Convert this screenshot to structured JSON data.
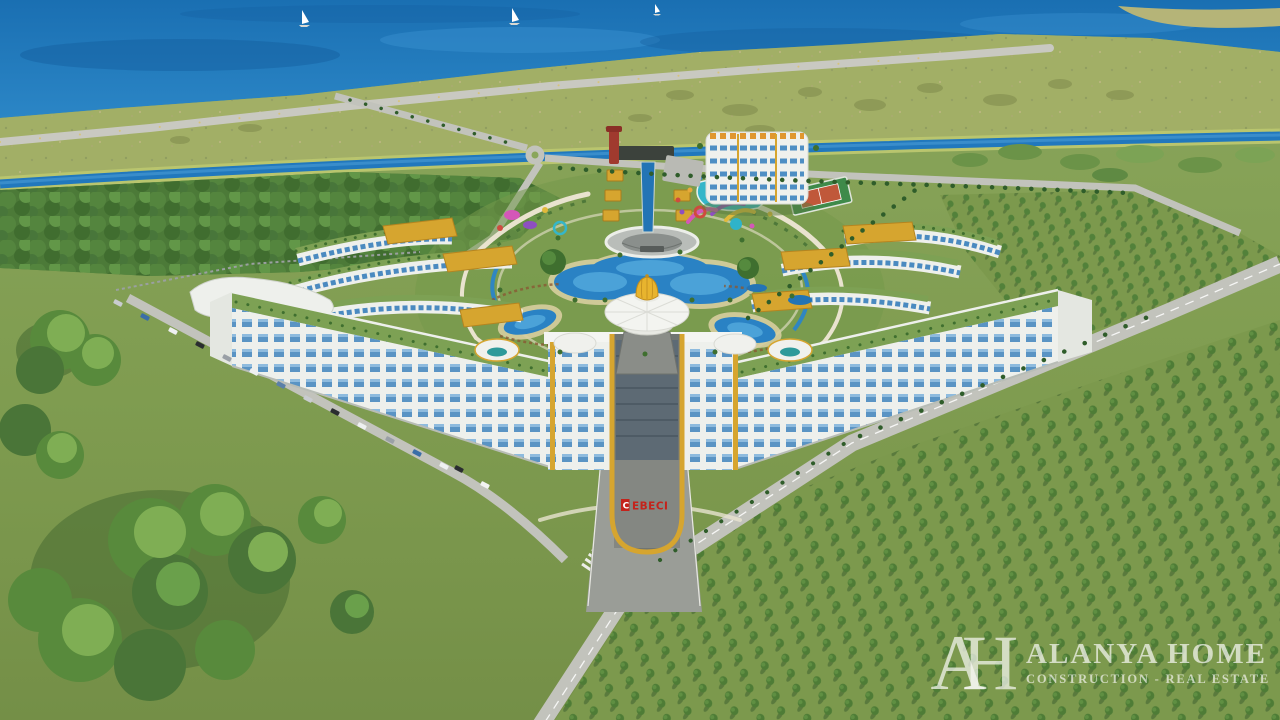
{
  "scene": {
    "type": "aerial 3D architectural render",
    "subject": "Seafront resort apartment complex masterplan with central domed pavilion, pools, waterpark and orchards",
    "sign": {
      "text": "CEBECI",
      "first": "C",
      "rest": "EBECI",
      "color": "#c4231b"
    },
    "watermark": {
      "monogram": "AH",
      "title": "ALANYA HOME",
      "subtitle": "CONSTRUCTION - REAL ESTATE",
      "color": "#f5f7f2"
    },
    "environment": {
      "sailboats": 3,
      "parked_cars": 15,
      "sea_position": "top",
      "orchard_position": "bottom-right",
      "forest_position": "left and bottom-left"
    },
    "palette": {
      "sea": "#1d74b6",
      "shore": "#a7b06a",
      "grass": "#7f9c50",
      "forest": "#4c7a38",
      "road": "#c2c3bc",
      "building_white": "#f0f1ed",
      "window_glass": "#4a8ac0",
      "gold_accent": "#d6a52f",
      "pool_blue": "#2a82c4",
      "waterpark_teal": "#35b6c9",
      "court_red": "#c0583a"
    }
  }
}
